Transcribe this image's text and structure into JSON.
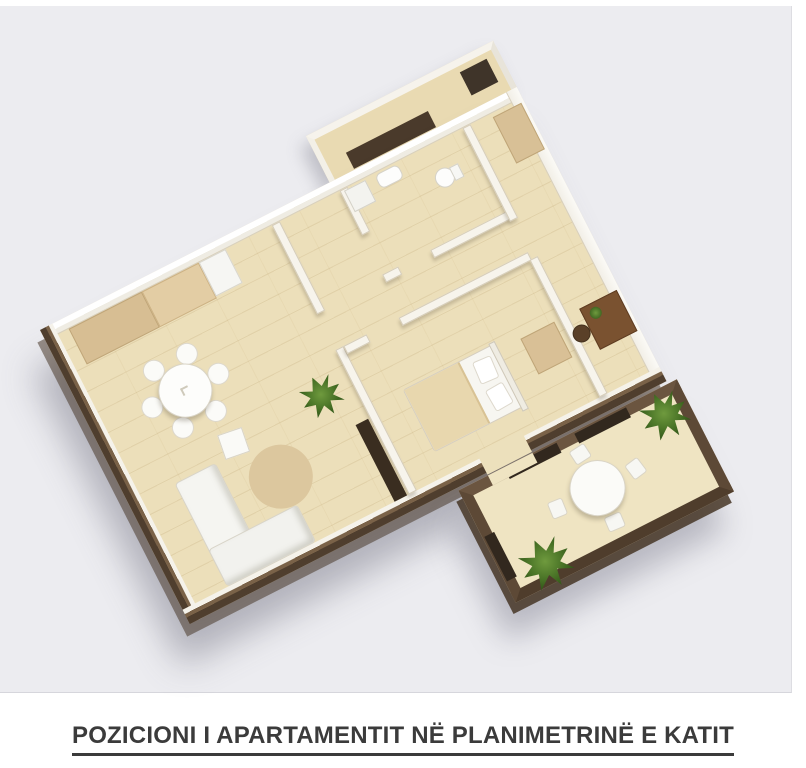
{
  "caption": {
    "text": "POZICIONI I APARTAMENTIT NË PLANIMETRINË E KATIT"
  },
  "scene": {
    "kind": "3d-floorplan-render",
    "rotation_deg": -27
  },
  "colors": {
    "page_background": "#ffffff",
    "plan_background": "#ececf0",
    "floor_wood": "#ecdfba",
    "floor_balcony": "#efe4c2",
    "wall_white": "#f6f3ec",
    "wall_brown": "#5d4936",
    "wall_brown_dark": "#43342a",
    "furniture_white": "#fafaf7",
    "furniture_beige": "#d7be93",
    "rug_beige": "#dcc79e",
    "plant_green": "#4a7427",
    "desk_brown": "#7a5230",
    "dark_unit": "#3a2d20",
    "caption_text": "#3b3b3b"
  },
  "furniture_icons": [
    "kitchen-counter",
    "kitchen-appliance",
    "dining-table-set",
    "side-table",
    "area-rug",
    "corner-sofa",
    "indoor-plant",
    "tv-cabinet",
    "toilet",
    "bathroom-sink",
    "shower-unit",
    "double-bed",
    "pillows",
    "dresser",
    "wardrobe",
    "desk",
    "desk-chair",
    "desk-plant",
    "balcony-table",
    "balcony-chairs",
    "balcony-plant",
    "entry-niche",
    "parapet-panel"
  ]
}
